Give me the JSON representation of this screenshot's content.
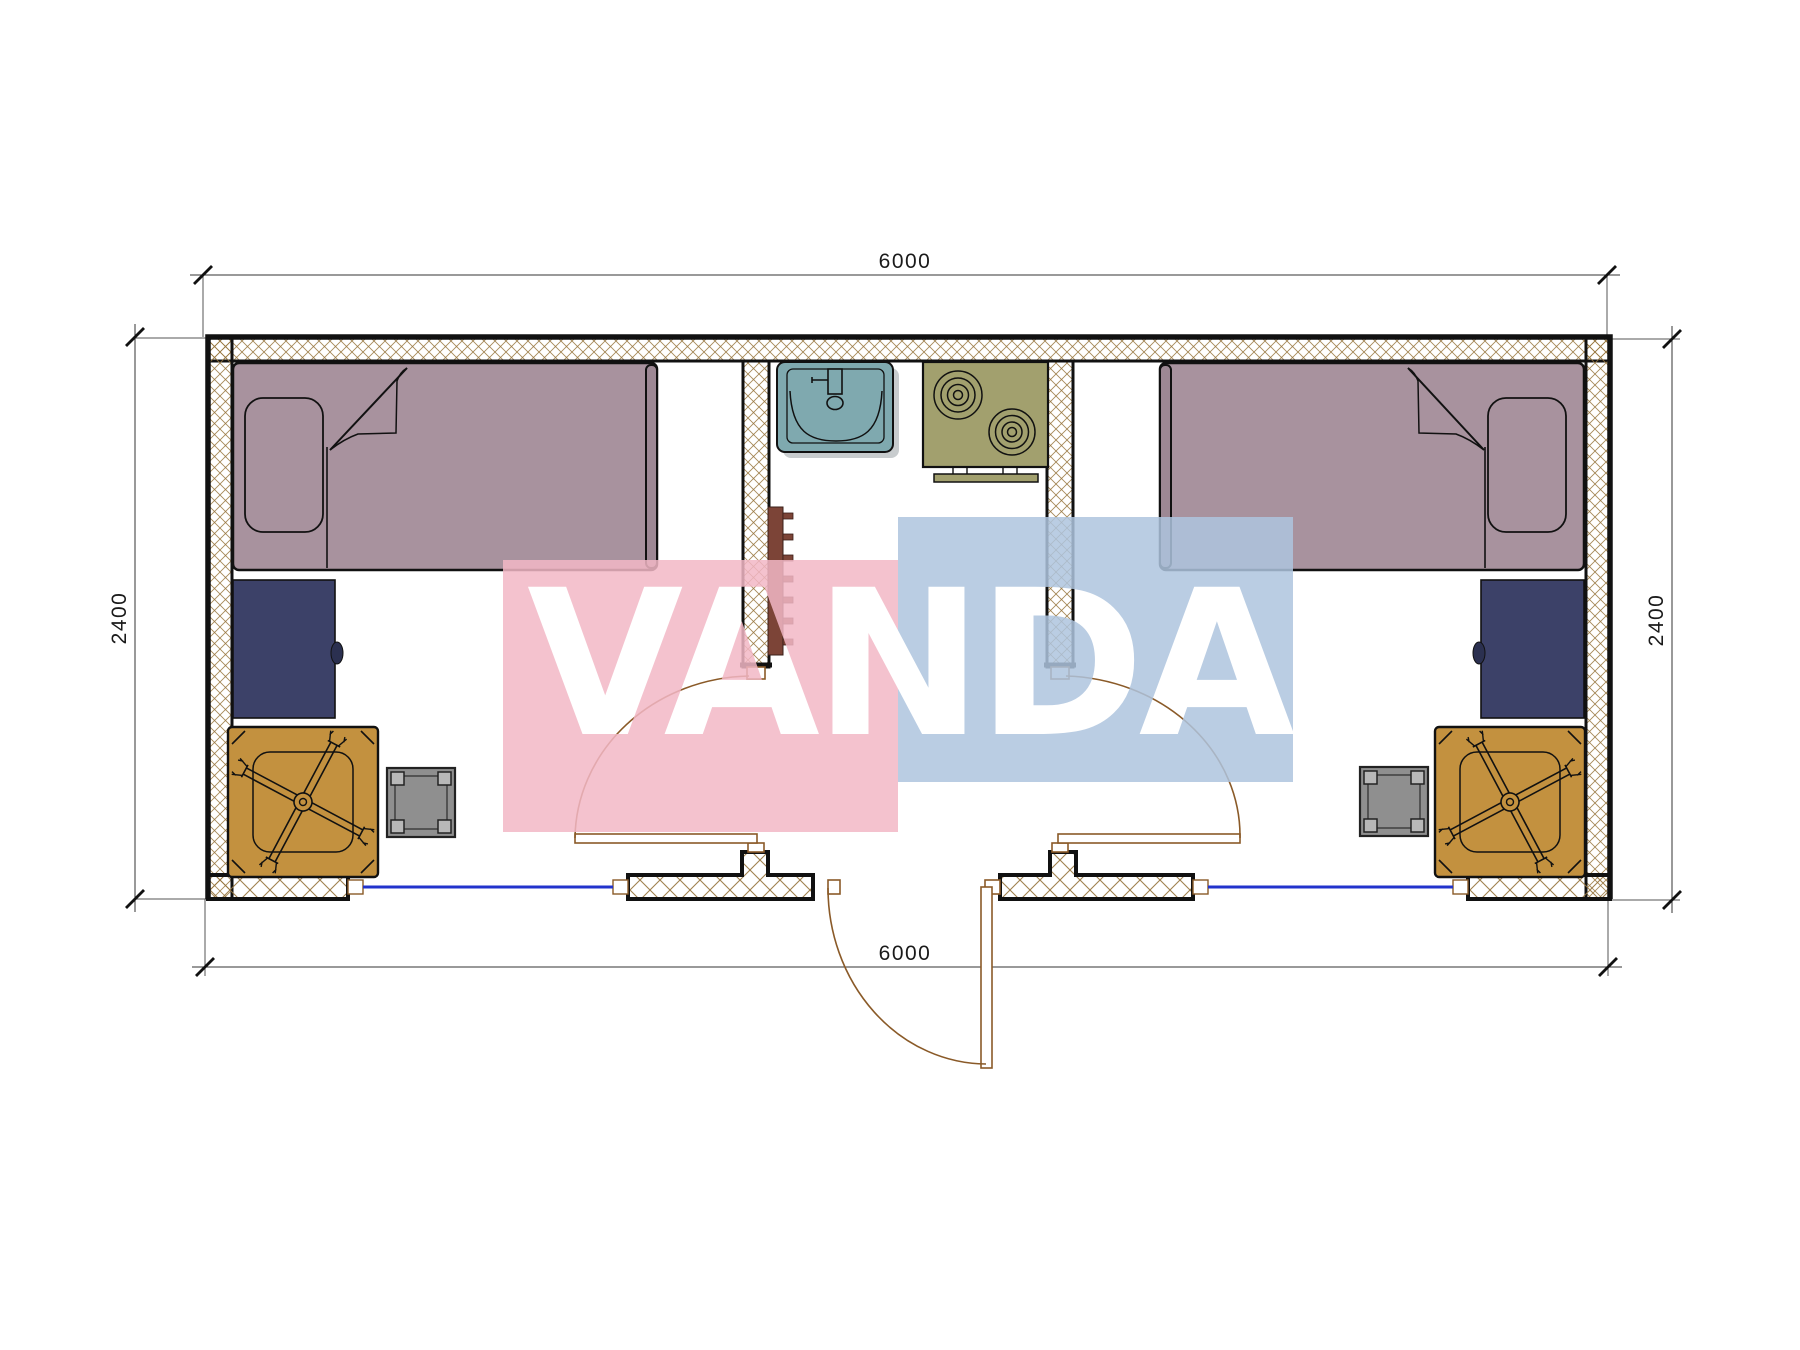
{
  "watermark": {
    "text": "VANDA",
    "pink_block": "#f2b7c5",
    "blue_block": "#aec4de"
  },
  "dimensions": {
    "top": "6000",
    "bottom": "6000",
    "left": "2400",
    "right": "2400"
  },
  "colors": {
    "wall_hatch": "#96743c",
    "wall_line": "#111111",
    "bed": "#a8929e",
    "bed_footboard": "#9d8894",
    "desk": "#3c4168",
    "desk_knob": "#2b3050",
    "chair": "#c3913f",
    "side_table": "#8f8f8f",
    "side_table_post": "#b8b8b8",
    "sink": "#7fa9af",
    "stove": "#a2a06e",
    "radiator": "#7c4437",
    "window_blue": "#2233cc",
    "door_tan": "#8a5a28",
    "dim_text": "#1a1a1a"
  }
}
